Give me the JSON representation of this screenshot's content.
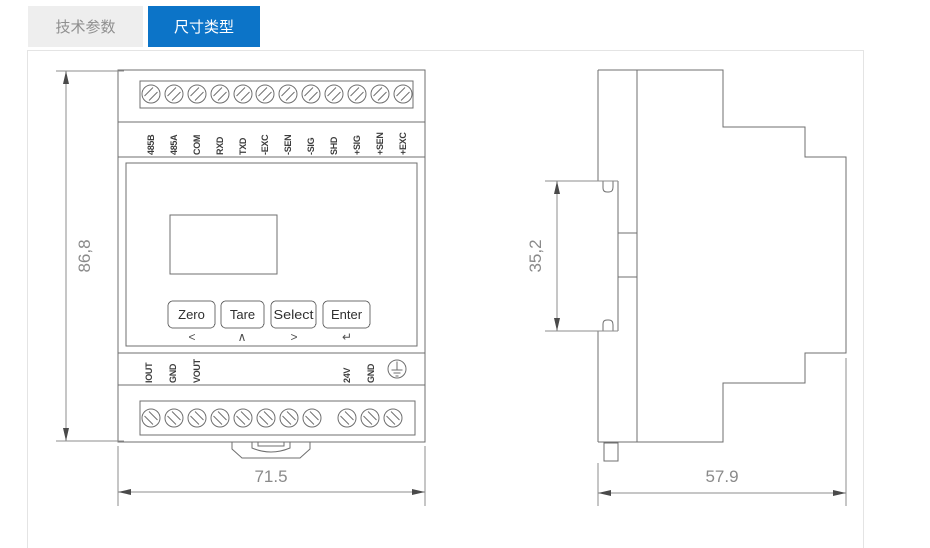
{
  "tabs": [
    {
      "label": "技术参数",
      "active": false
    },
    {
      "label": "尺寸类型",
      "active": true
    }
  ],
  "colors": {
    "active_tab_bg": "#0c74c8",
    "active_tab_text": "#ffffff",
    "inactive_tab_bg": "#eeeeee",
    "inactive_tab_text": "#8f8f8f",
    "drawing_line": "#6f6f6f",
    "dimension_text": "#8a8a8a"
  },
  "front_view": {
    "top_terminals": [
      "485B",
      "485A",
      "COM",
      "RXD",
      "TXD",
      "-EXC",
      "-SEN",
      "-SIG",
      "SHD",
      "+SIG",
      "+SEN",
      "+EXC"
    ],
    "bottom_left_terminals": [
      "IOUT",
      "GND",
      "VOUT"
    ],
    "bottom_right_terminals": [
      "24V",
      "GND"
    ],
    "buttons": [
      "Zero",
      "Tare",
      "Select",
      "Enter"
    ],
    "button_symbols": [
      "<",
      "∧",
      ">",
      "↵"
    ],
    "dimensions": {
      "height": "86,8",
      "width": "71.5"
    }
  },
  "side_view": {
    "dimensions": {
      "rail_height": "35,2",
      "depth": "57.9"
    }
  },
  "icons": {
    "protective_earth": "⏚",
    "screw_terminal": "⊘"
  }
}
